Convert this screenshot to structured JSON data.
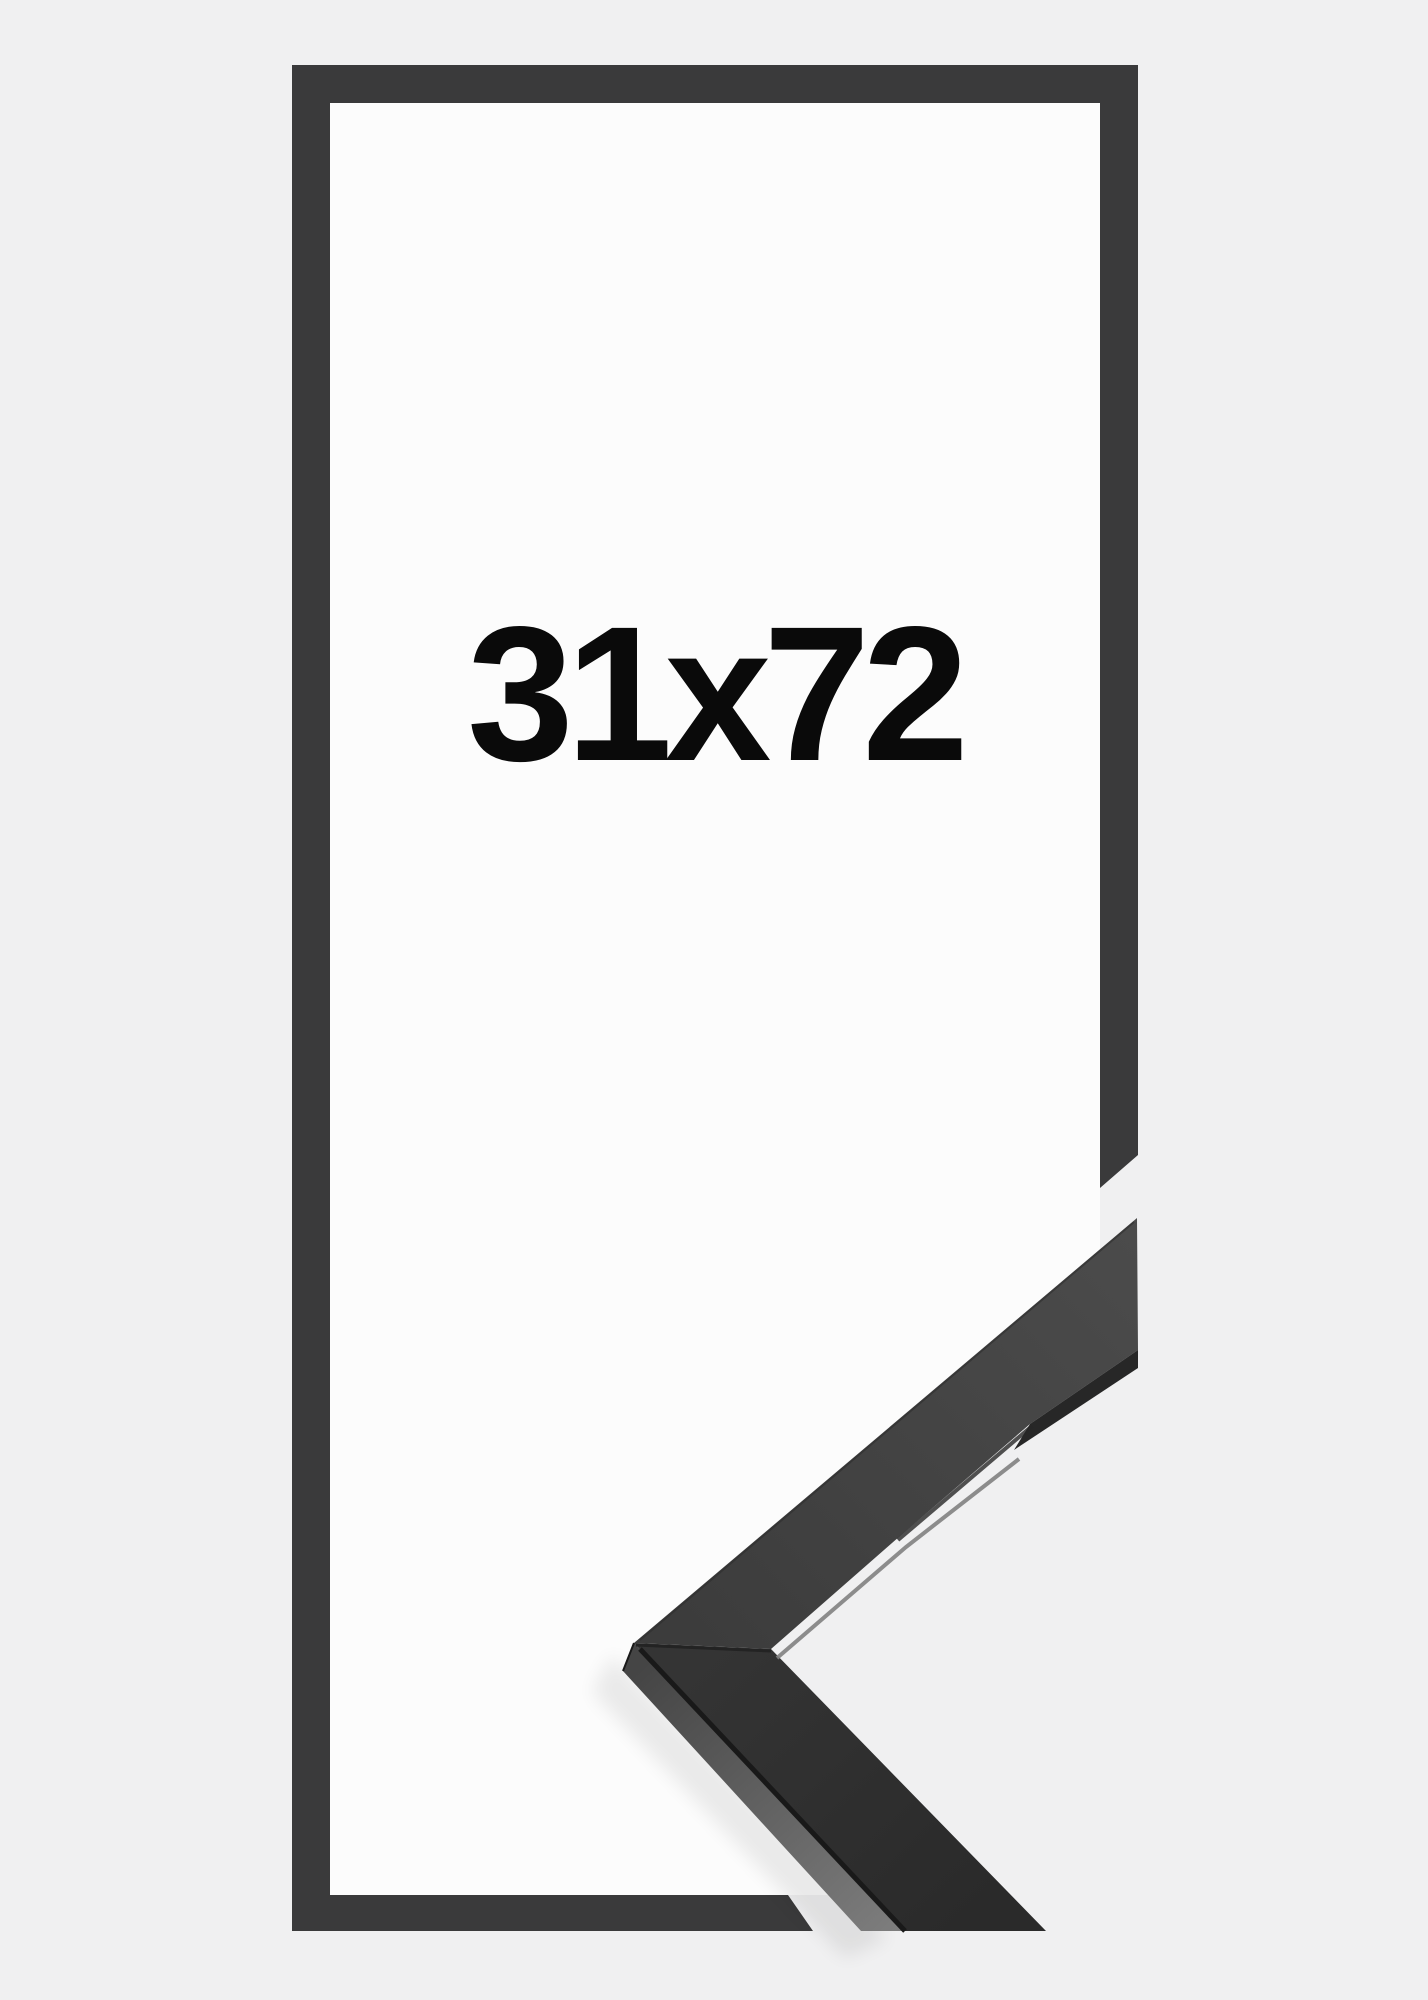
{
  "product": {
    "size_label": "31x72"
  },
  "colors": {
    "background": "#f0f0f1",
    "paper": "#fcfcfc",
    "frame_outline": "#3a3a3b",
    "moulding_face_upper_light": "#4b4b4b",
    "moulding_face_upper_dark": "#3c3c3c",
    "moulding_face_lower_top": "#343434",
    "moulding_face_lower_bottom": "#2a2a2a",
    "moulding_side_top": "#454545",
    "moulding_side_bottom": "#7d7d7d",
    "seam": "#191919",
    "miter_seam": "#232323",
    "edge_highlight": "#818181",
    "edge_shadow": "#272727",
    "corner_arris": "#2c2c2c",
    "text": "#0a0a0a"
  }
}
